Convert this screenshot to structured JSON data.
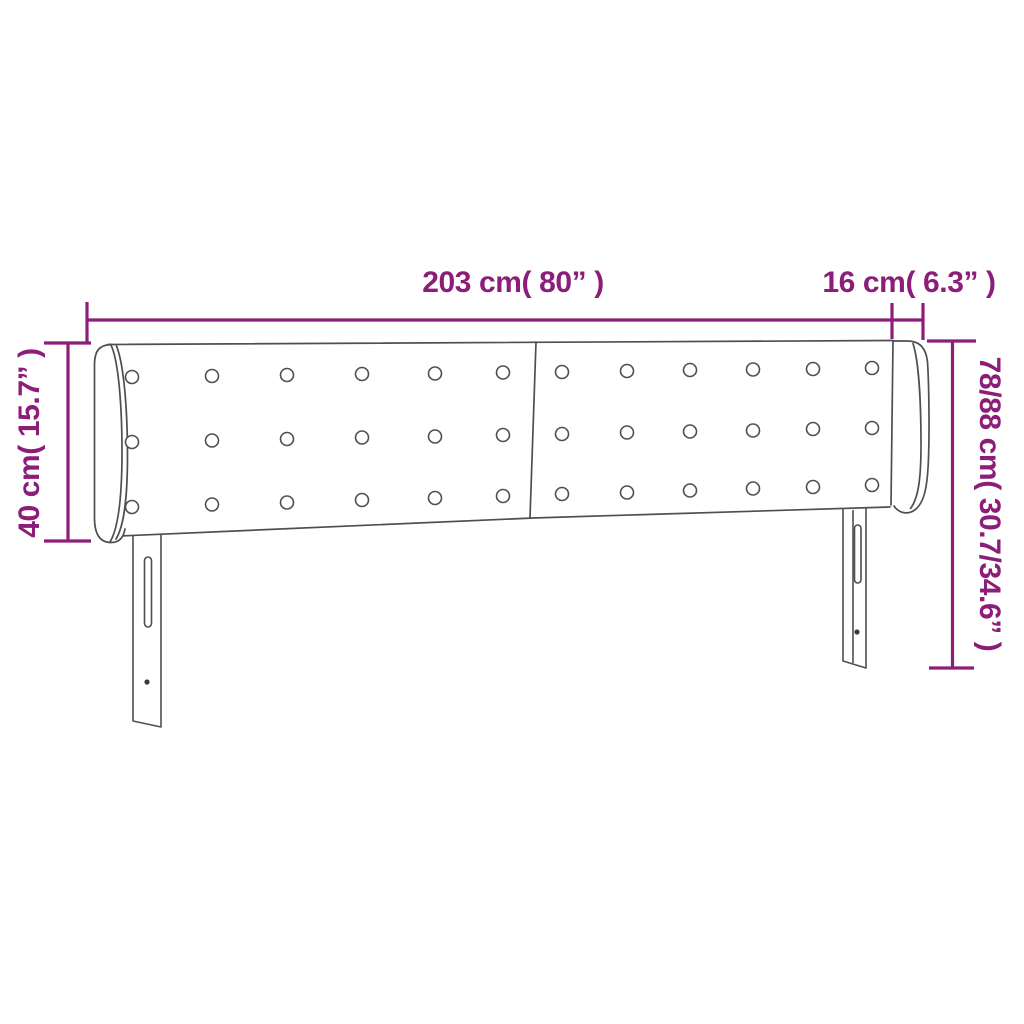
{
  "diagram": {
    "type": "product-dimension-diagram",
    "subject": "upholstered headboard with side wings, button tufting and two slotted legs",
    "accent_color": "#8C1D78",
    "line_color": "#4F4F4F",
    "background_color": "#FFFFFF",
    "labels": {
      "total_width": "203 cm( 80” )",
      "wing_width": "16 cm( 6.3” )",
      "wing_height": "40 cm( 15.7” )",
      "total_height": "78/88 cm( 30.7/34.6” )"
    },
    "features": {
      "button_rows": 3,
      "button_columns": 12,
      "panels": 2,
      "wings": 2,
      "legs": 2,
      "slots_per_leg": 1,
      "screw_holes_per_leg": 1
    }
  }
}
